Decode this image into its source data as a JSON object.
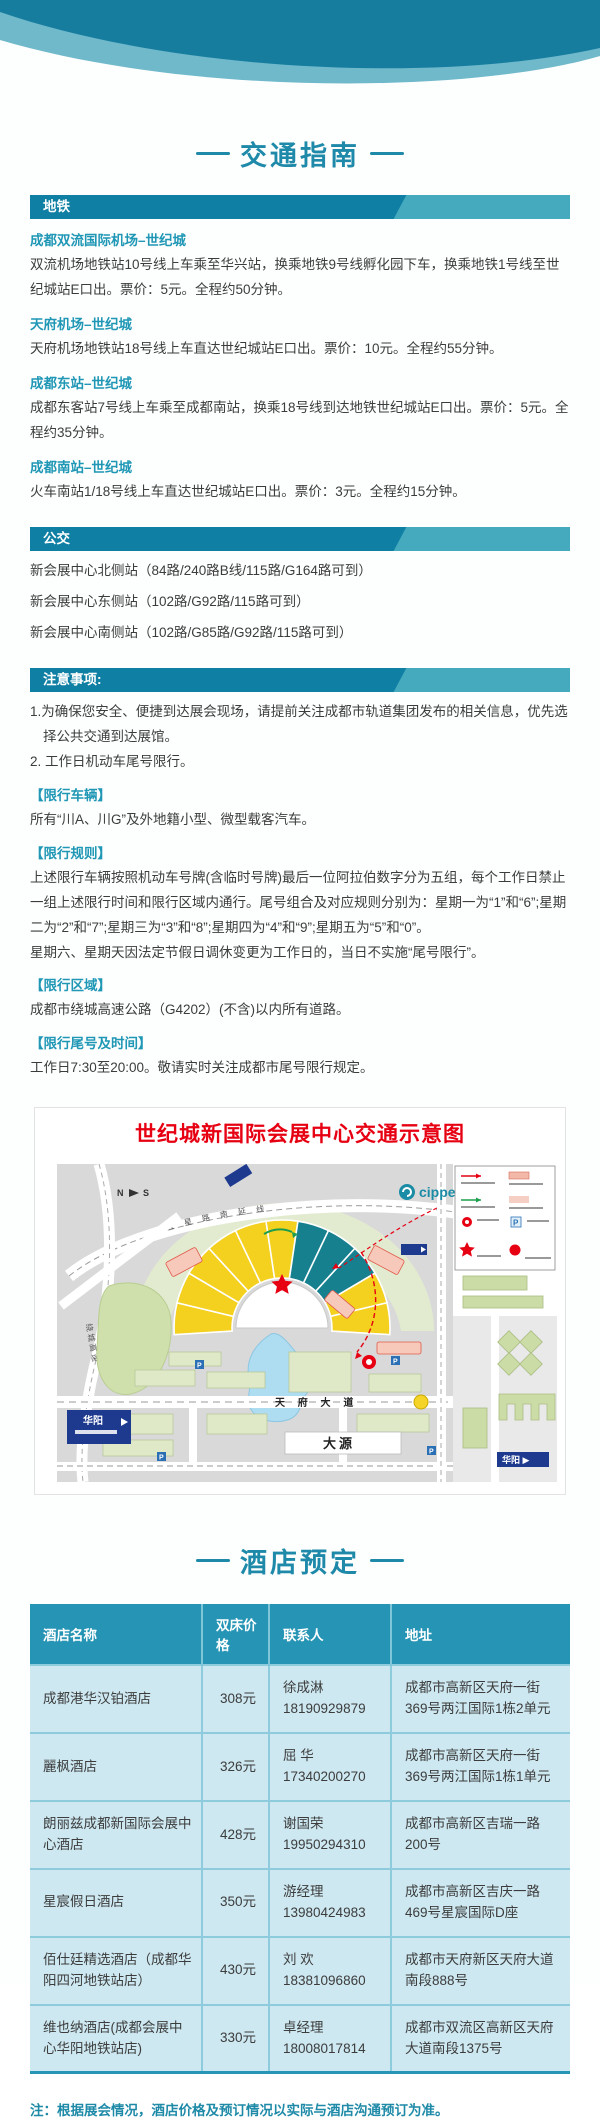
{
  "colors": {
    "accent_teal": "#1e89a9",
    "bar_dark": "#0f7fa3",
    "bar_light": "#46aabf",
    "subtitle_teal": "#1f97b5",
    "map_title_red": "#e60012",
    "table_header_bg": "#2694b4",
    "table_row_bg": "#cde8f1",
    "hall_yellow": "#f4d01f",
    "hall_teal": "#17808f"
  },
  "traffic_guide": {
    "title": "交通指南",
    "metro": {
      "header": "地铁",
      "items": [
        {
          "route": "成都双流国际机场–世纪城",
          "desc": "双流机场地铁站10号线上车乘至华兴站，换乘地铁9号线孵化园下车，换乘地铁1号线至世纪城站E口出。票价：5元。全程约50分钟。"
        },
        {
          "route": "天府机场–世纪城",
          "desc": "天府机场地铁站18号线上车直达世纪城站E口出。票价：10元。全程约55分钟。"
        },
        {
          "route": "成都东站–世纪城",
          "desc": "成都东客站7号线上车乘至成都南站，换乘18号线到达地铁世纪城站E口出。票价：5元。全程约35分钟。"
        },
        {
          "route": "成都南站–世纪城",
          "desc": "火车南站1/18号线上车直达世纪城站E口出。票价：3元。全程约15分钟。"
        }
      ]
    },
    "bus": {
      "header": "公交",
      "items": [
        "新会展中心北侧站（84路/240路B线/115路/G164路可到）",
        "新会展中心东侧站（102路/G92路/115路可到）",
        "新会展中心南侧站（102路/G85路/G92路/115路可到）"
      ]
    },
    "notes": {
      "header": "注意事项:",
      "item1": "1.为确保您安全、便捷到达展会现场，请提前关注成都市轨道集团发布的相关信息，优先选择公共交通到达展馆。",
      "item2": "2. 工作日机动车尾号限行。",
      "blocks": [
        {
          "label": "【限行车辆】",
          "text": "所有“川A、川G”及外地籍小型、微型载客汽车。"
        },
        {
          "label": "【限行规则】",
          "text": "上述限行车辆按照机动车号牌(含临时号牌)最后一位阿拉伯数字分为五组，每个工作日禁止一组上述限行时间和限行区域内通行。尾号组合及对应规则分别为：星期一为“1”和“6”;星期二为“2”和“7”;星期三为“3”和“8”;星期四为“4”和“9”;星期五为“5”和“0”。",
          "text2": "星期六、星期天因法定节假日调休变更为工作日的，当日不实施“尾号限行”。"
        },
        {
          "label": "【限行区域】",
          "text": "成都市绕城高速公路（G4202）(不含)以内所有道路。"
        },
        {
          "label": "【限行尾号及时间】",
          "text": "工作日7:30至20:00。敬请实时关注成都市尾号限行规定。"
        }
      ]
    }
  },
  "map": {
    "title": "世纪城新国际会展中心交通示意图",
    "brand": "cippe",
    "compass_n": "N",
    "compass_s": "S",
    "labels": {
      "north_road": "红 星 路 南 延 线",
      "ring_road": "绕 城 高 速",
      "tianfu_avenue": "天 府 大 道",
      "dayuan": "大源",
      "huayang": "华阳",
      "huayang_right": "华阳 ▶"
    }
  },
  "hotels": {
    "title": "酒店预定",
    "table": {
      "headers": [
        "酒店名称",
        "双床价格",
        "联系人",
        "地址"
      ],
      "rows": [
        {
          "name": "成都港华汉铂酒店",
          "price": "308元",
          "contact_name": "徐成淋",
          "contact_phone": "18190929879",
          "address": "成都市高新区天府一街369号两江国际1栋2单元"
        },
        {
          "name": "麗枫酒店",
          "price": "326元",
          "contact_name": "屈 华",
          "contact_phone": "17340200270",
          "address": "成都市高新区天府一街369号两江国际1栋1单元"
        },
        {
          "name": "朗丽兹成都新国际会展中心酒店",
          "price": "428元",
          "contact_name": "谢国荣",
          "contact_phone": "19950294310",
          "address": "成都市高新区吉瑞一路200号"
        },
        {
          "name": "星宸假日酒店",
          "price": "350元",
          "contact_name": "游经理",
          "contact_phone": "13980424983",
          "address": "成都市高新区吉庆一路469号星宸国际D座"
        },
        {
          "name": "佰仕廷精选酒店（成都华阳四河地铁站店）",
          "price": "430元",
          "contact_name": "刘 欢",
          "contact_phone": "18381096860",
          "address": "成都市天府新区天府大道南段888号"
        },
        {
          "name": "维也纳酒店(成都会展中心华阳地铁站店)",
          "price": "330元",
          "contact_name": "卓经理",
          "contact_phone": "18008017814",
          "address": "成都市双流区高新区天府大道南段1375号"
        }
      ]
    },
    "note": "注：根据展会情况，酒店价格及预订情况以实际与酒店沟通预订为准。"
  }
}
